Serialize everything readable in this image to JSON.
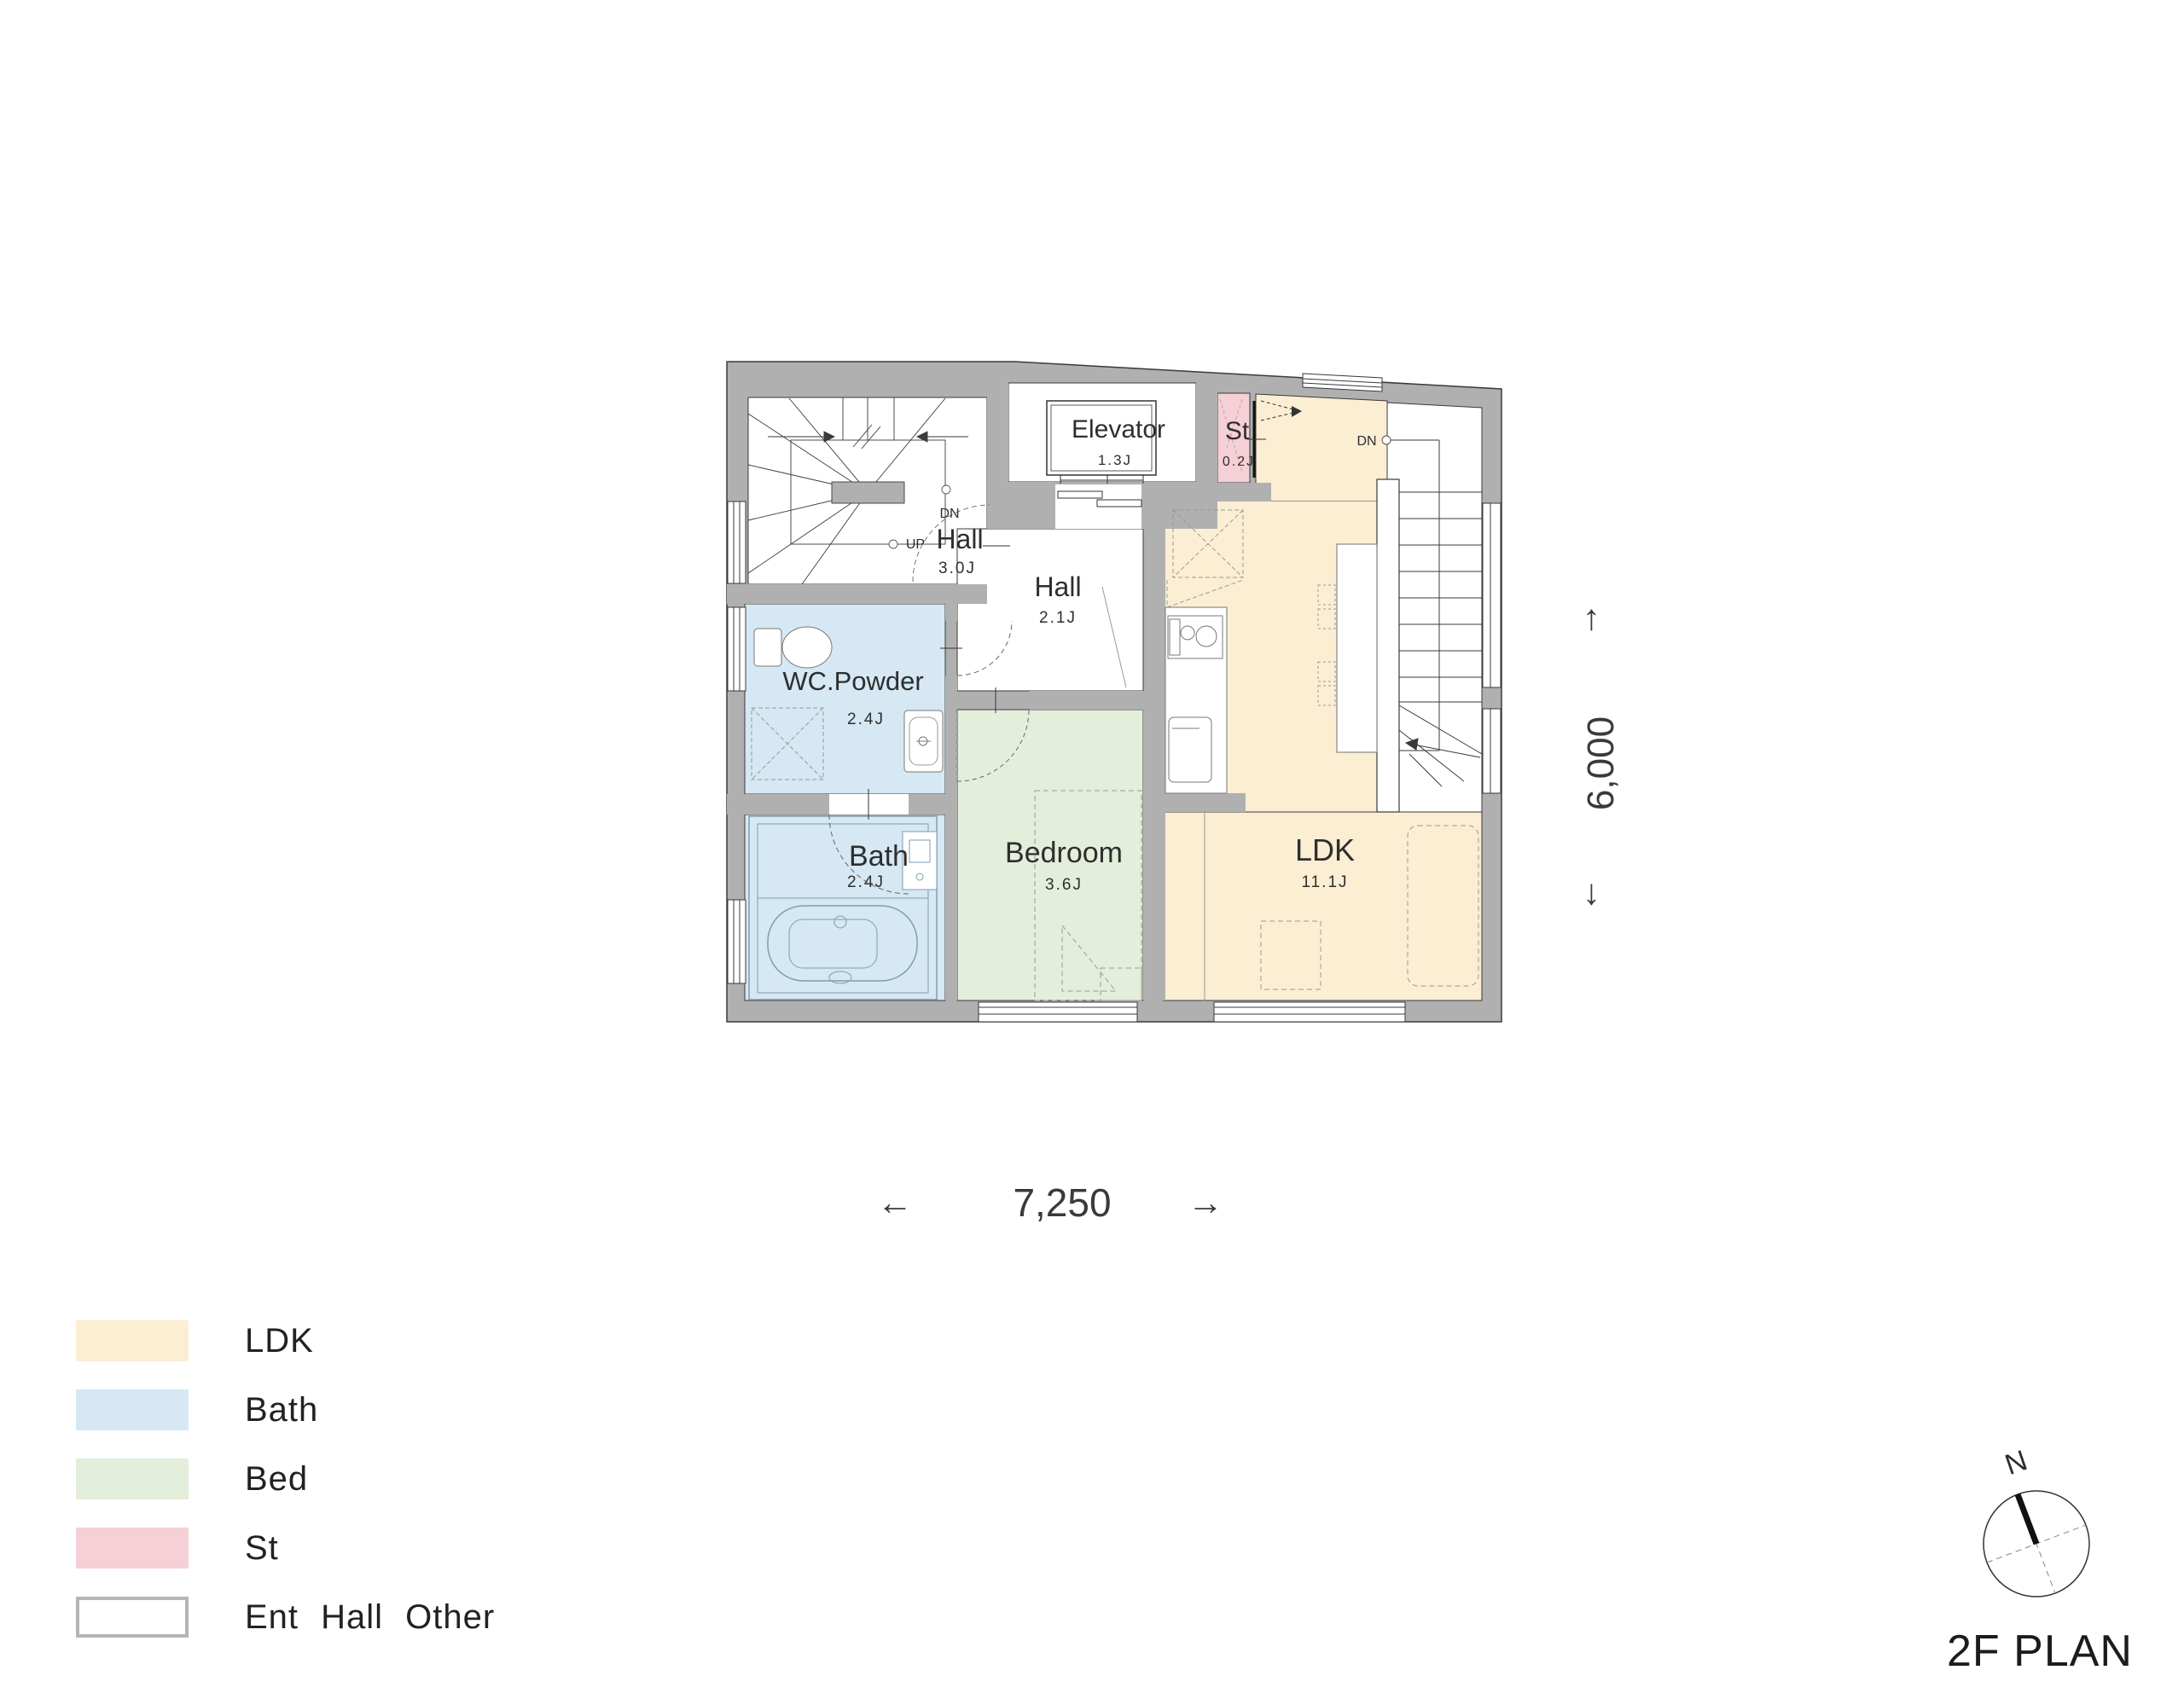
{
  "colors": {
    "wall": "#B0B0B0",
    "ldk": "#FBEED3",
    "bath": "#D5E8F3",
    "bed": "#E3EEDB",
    "st": "#F5D0D6",
    "room_white": "#FFFFFF"
  },
  "plan": {
    "rooms": {
      "elevator": {
        "label": "Elevator",
        "area": "1.3J"
      },
      "st": {
        "label": "St",
        "area": "0.2J"
      },
      "hall_upper": {
        "label": "Hall",
        "area": "3.0J"
      },
      "hall_lower": {
        "label": "Hall",
        "area": "2.1J"
      },
      "wc_powder": {
        "label": "WC.Powder",
        "area": "2.4J"
      },
      "bath": {
        "label": "Bath",
        "area": "2.4J"
      },
      "bedroom": {
        "label": "Bedroom",
        "area": "3.6J"
      },
      "ldk": {
        "label": "LDK",
        "area": "11.1J"
      }
    },
    "stair_annotations": {
      "dn": "DN",
      "up": "UP",
      "dn_right": "DN"
    },
    "dimensions": {
      "width": "7,250",
      "height": "6,000",
      "arrow_left": "←",
      "arrow_right": "→",
      "arrow_up": "↑",
      "arrow_down": "↓"
    }
  },
  "legend": {
    "items": [
      {
        "label": "LDK",
        "color": "#FBEED3"
      },
      {
        "label": "Bath",
        "color": "#D5E8F3"
      },
      {
        "label": "Bed",
        "color": "#E3EEDB"
      },
      {
        "label": "St",
        "color": "#F5D0D6"
      },
      {
        "label": "Ent Hall Other",
        "color": "#FFFFFF"
      }
    ]
  },
  "footer": {
    "compass_north": "N",
    "title": "2F PLAN"
  }
}
